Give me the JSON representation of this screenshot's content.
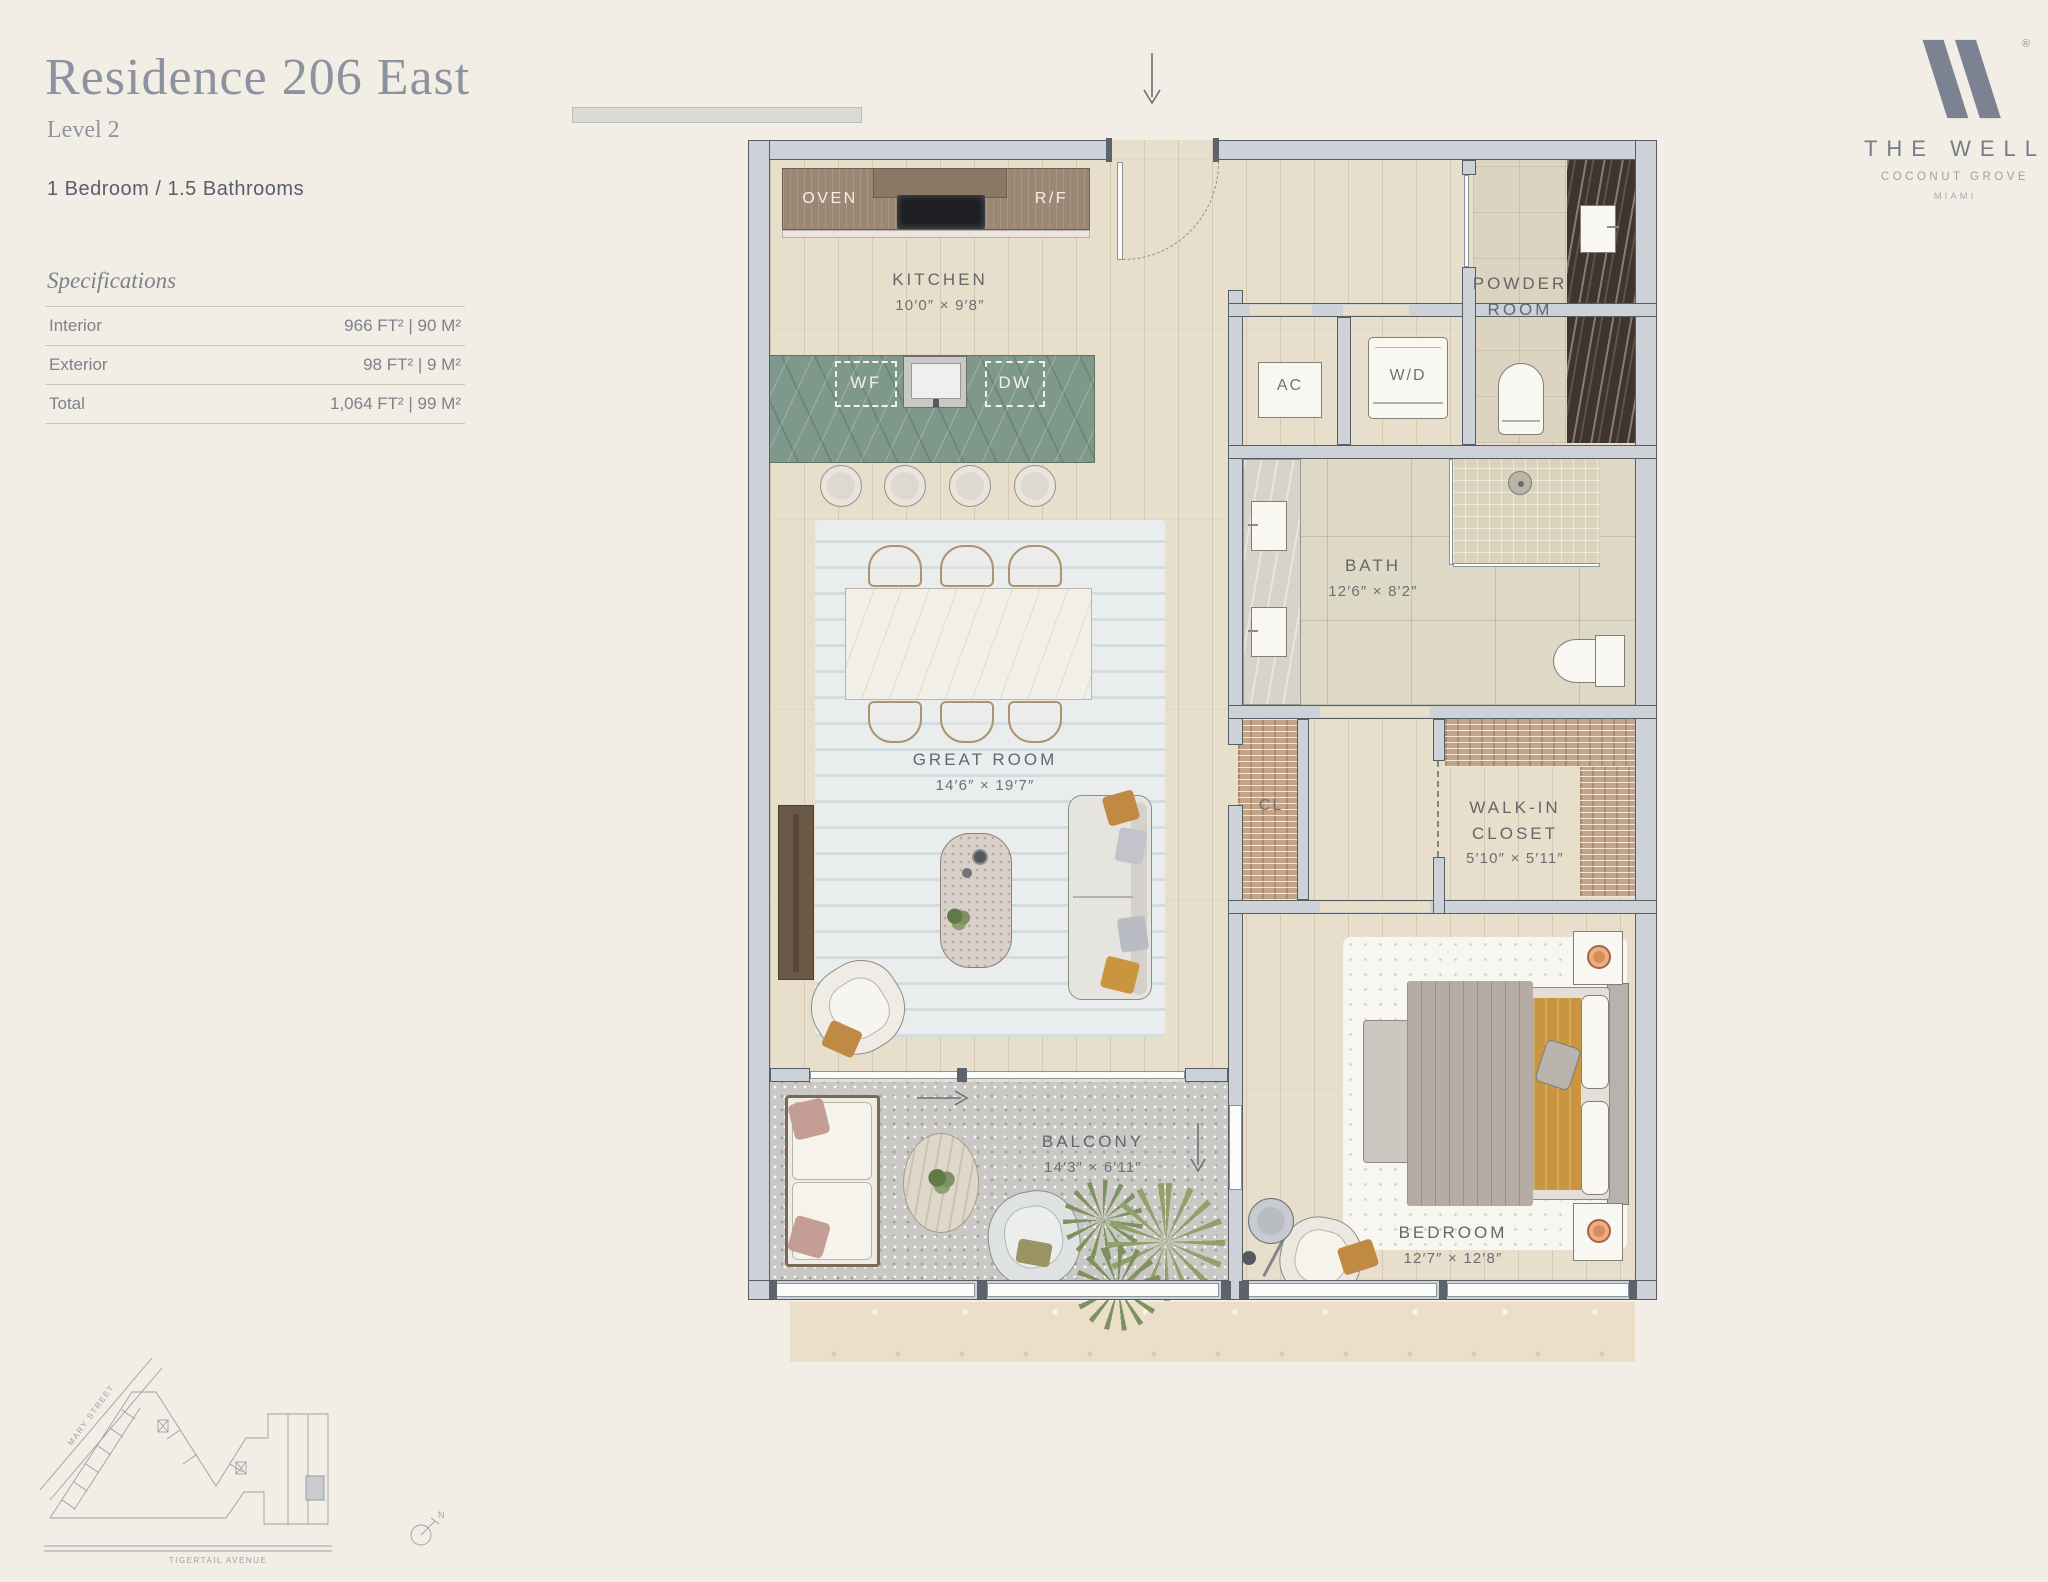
{
  "header": {
    "title": "Residence 206 East",
    "level": "Level 2",
    "config": "1 Bedroom / 1.5 Bathrooms"
  },
  "specifications": {
    "title": "Specifications",
    "rows": [
      {
        "label": "Interior",
        "value": "966 FT²  |  90 M²"
      },
      {
        "label": "Exterior",
        "value": "98 FT²  |  9 M²"
      },
      {
        "label": "Total",
        "value": "1,064 FT²  |  99 M²"
      }
    ]
  },
  "logo": {
    "registered": "®",
    "brand": "THE WELL",
    "location": "COCONUT GROVE",
    "city": "MIAMI"
  },
  "floorplan": {
    "rooms": {
      "kitchen": {
        "name": "KITCHEN",
        "dim": "10′0″ × 9′8″"
      },
      "great_room": {
        "name": "GREAT ROOM",
        "dim": "14′6″ × 19′7″"
      },
      "bath": {
        "name": "BATH",
        "dim": "12′6″ × 8′2″"
      },
      "powder_room": {
        "line1": "POWDER",
        "line2": "ROOM"
      },
      "walk_in_closet": {
        "line1": "WALK-IN",
        "line2": "CLOSET",
        "dim": "5′10″ × 5′11″"
      },
      "bedroom": {
        "name": "BEDROOM",
        "dim": "12′7″ × 12′8″"
      },
      "balcony": {
        "name": "BALCONY",
        "dim": "14′3″ × 6′11″"
      }
    },
    "fixtures": {
      "oven": "OVEN",
      "fridge": "R/F",
      "wine_fridge": "WF",
      "dishwasher": "DW",
      "ac_unit": "AC",
      "washer_dryer": "W/D",
      "closet": "CL"
    }
  },
  "keyplan": {
    "street_mary": "MARY STREET",
    "street_tigertail": "TIGERTAIL AVENUE",
    "compass_north": "N"
  },
  "colors": {
    "background": "#f2eee5",
    "title_text": "#8c92a0",
    "body_text": "#575e6b",
    "label_text": "#64676b",
    "wall": "#cdd2d9",
    "wood_floor": "#e8decc",
    "island_marble": "#7e988b",
    "cabinet_wood": "#9b8773",
    "bath_tile": "#ded9c6",
    "dark_marble": "#3e362e",
    "terrazzo": "#c9c8c4",
    "accent_orange": "#c9913f",
    "logo_gray": "#7b8292"
  }
}
